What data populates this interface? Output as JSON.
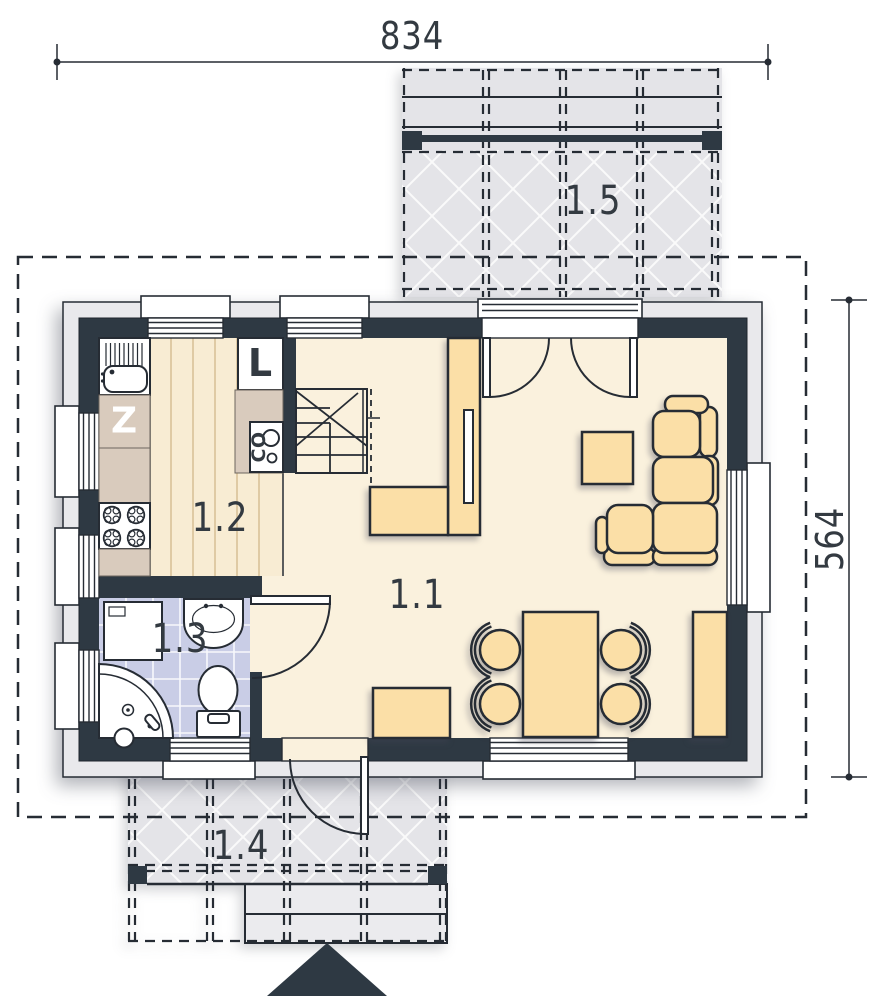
{
  "drawing": {
    "dimensions": {
      "width_label": "834",
      "height_label": "564"
    },
    "rooms": {
      "living": {
        "label": "1.1"
      },
      "kitchen": {
        "label": "1.2"
      },
      "bathroom": {
        "label": "1.3"
      },
      "terrace_front": {
        "label": "1.4"
      },
      "terrace_rear": {
        "label": "1.5"
      }
    },
    "appliances": {
      "fridge_label": "L",
      "dishwasher_label": "Z",
      "boiler_label": "CO"
    }
  },
  "colors": {
    "wall": "#2e3943",
    "plinth": "#e9e9ec",
    "line": "#262c34",
    "interior_floor": "#faf1dd",
    "kitchen_floor": "#f8ecd3",
    "counter": "#d9cbbd",
    "furniture": "#fbdfa7",
    "bathroom_floor": "#c9cde6",
    "terrace": "#e4e4e8",
    "step": "#ebebee",
    "label": "#333a41",
    "appliance_glyph_light": "#ffffff"
  }
}
